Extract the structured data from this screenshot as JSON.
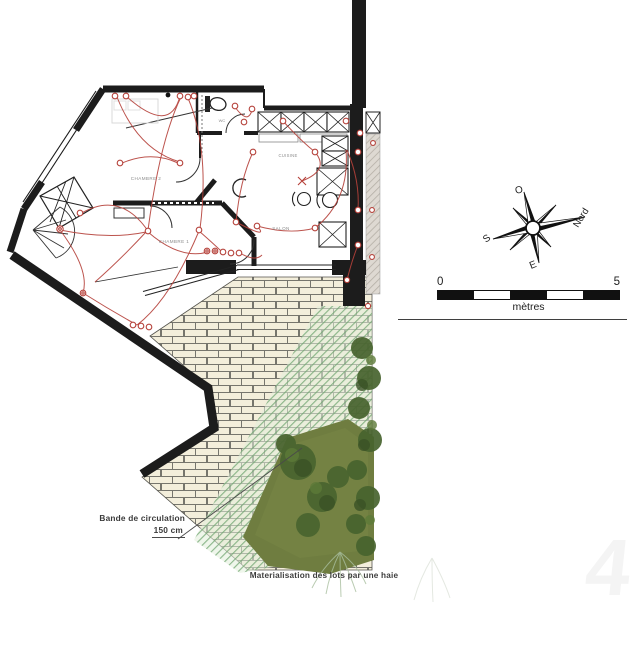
{
  "document": {
    "type": "architectural floor plan with terrace and garden"
  },
  "rooms": {
    "chambre2": "CHAMBRE 2",
    "chambre1": "CHAMBRE 1",
    "salon": "SALON",
    "cuisine": "CUISINE",
    "wc": "WC"
  },
  "compass": {
    "north": "Nord",
    "south": "S",
    "east": "E",
    "west": "O"
  },
  "scale_bar": {
    "start": "0",
    "end": "5",
    "unit": "mètres"
  },
  "annotations": {
    "circulation_label": "Bande de circulation",
    "circulation_value": "150 cm",
    "lots_label": "Materialisation des lots par une haie"
  },
  "watermark": "4",
  "colors": {
    "wall_black": "#1c1c1c",
    "electric_red": "#b5413a",
    "brick_fill": "#f3eedb",
    "brick_mortar": "#76756d",
    "hatch_green": "#74a874",
    "hatch_base": "#e2eeda",
    "garden_green": "#6f7d40",
    "bush_green": "#46602c"
  }
}
